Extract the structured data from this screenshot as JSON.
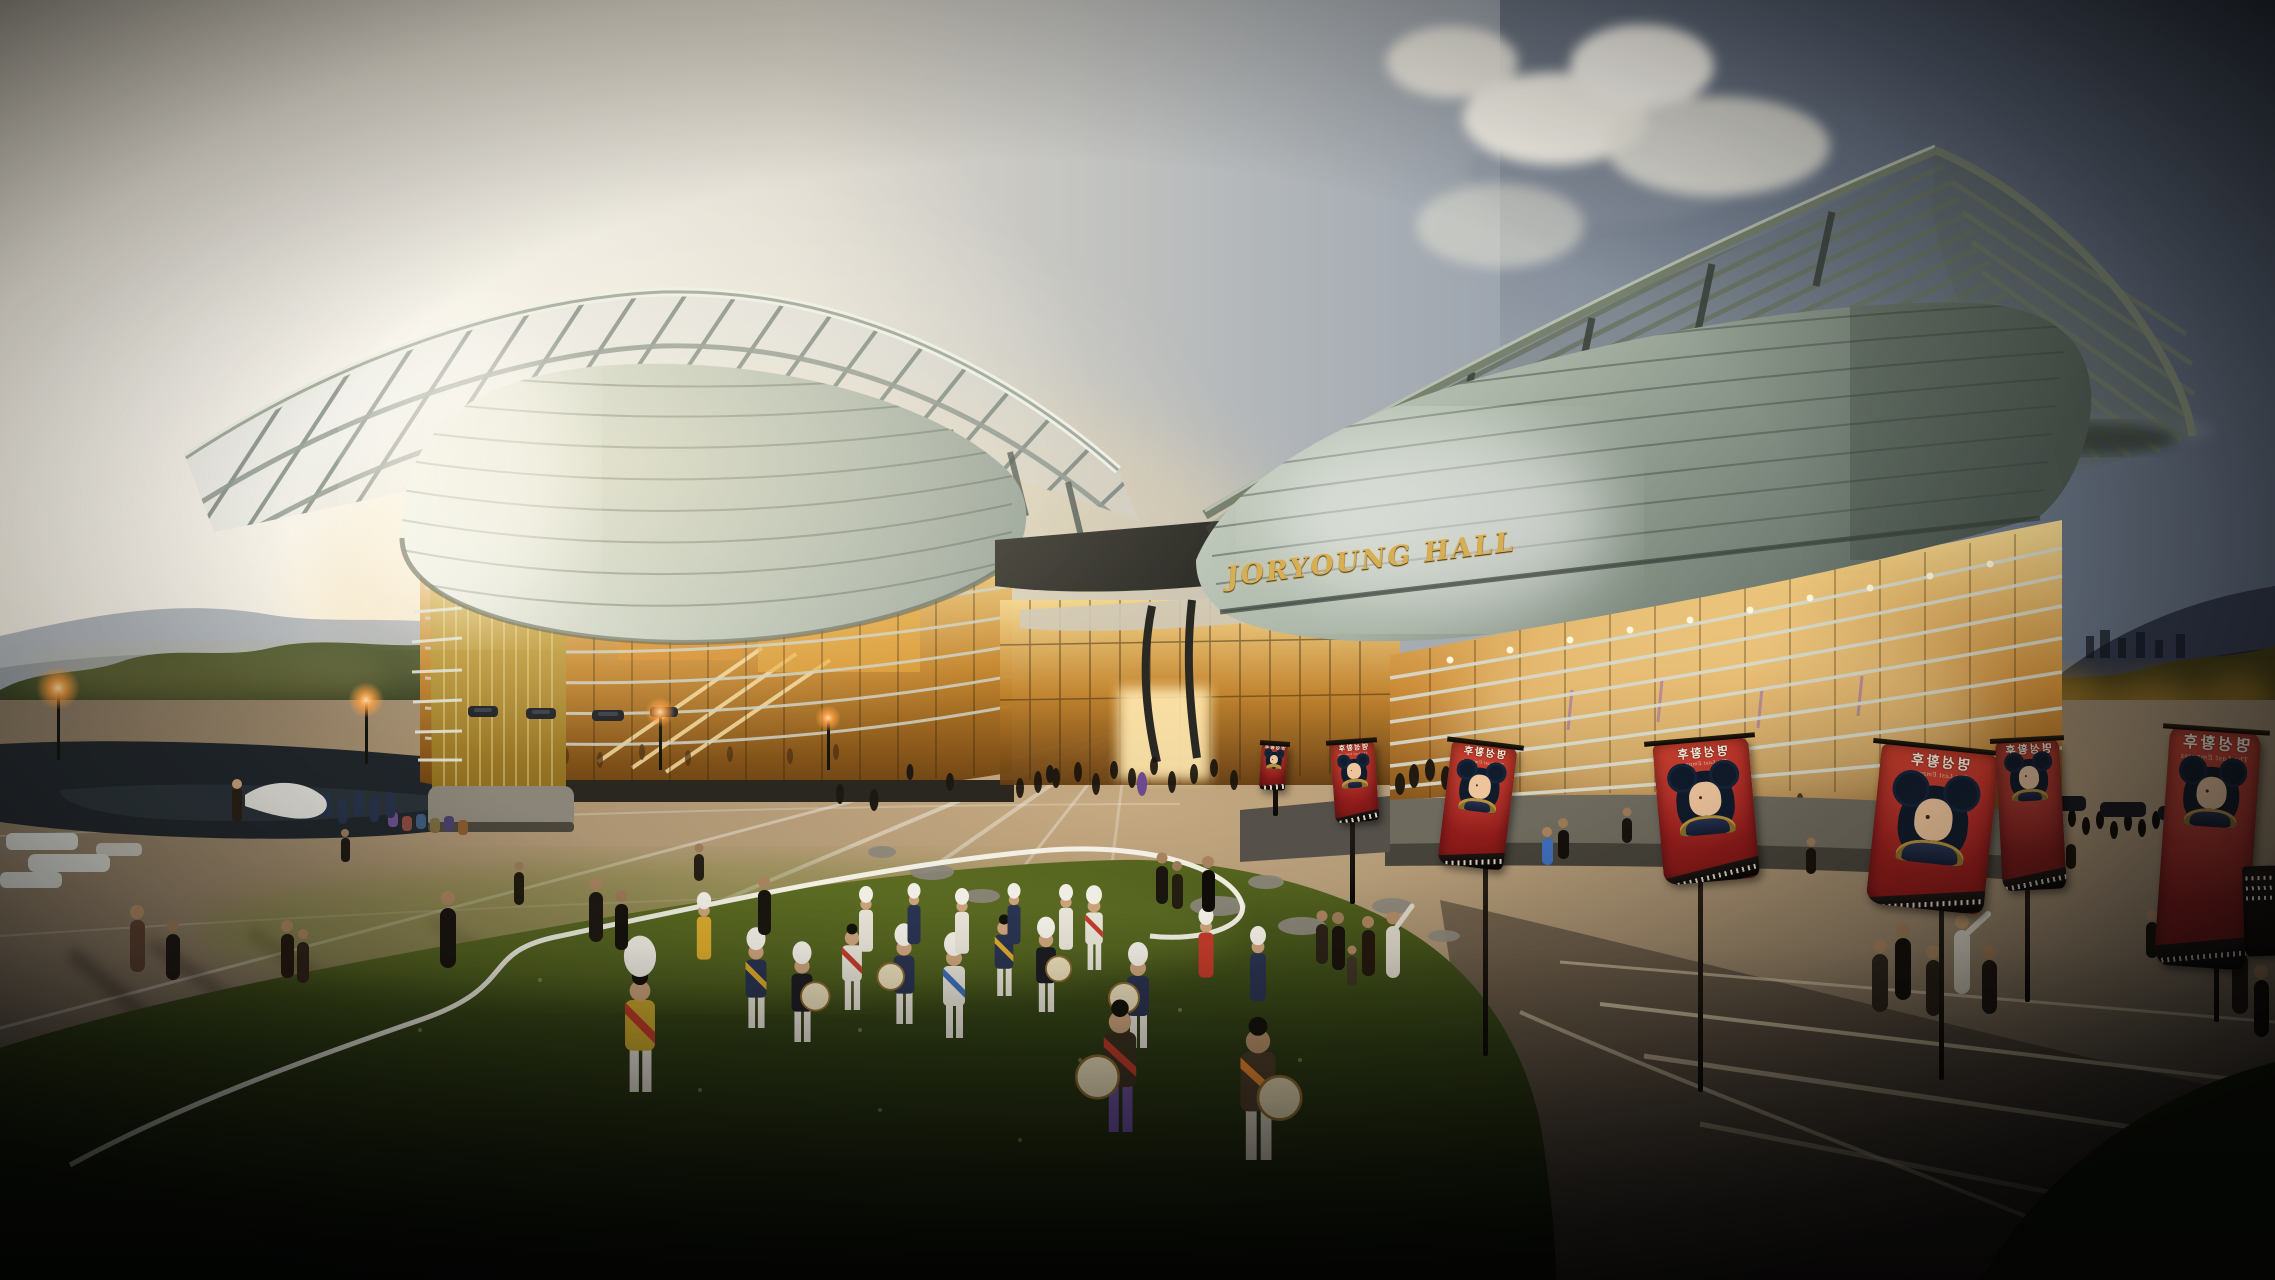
{
  "scene": {
    "description": "Dusk architectural rendering of a performing-arts complex with two winged halls, a plaza, a lawn with traditional Korean performers and rows of red event banners",
    "sign_text": "JORYOUNG HALL",
    "banner": {
      "title_ko": "명성황후",
      "caption": "The Last Empress",
      "mirrored": true
    },
    "palette": {
      "sky_warm": "#f2ead9",
      "sky_cool": "#59636f",
      "cloud_white": "#f6f3ea",
      "concrete_light": "#cdd5c8",
      "concrete_shadow": "#55605a",
      "glass_glow": "#f6d98e",
      "glass_deep": "#7a4a16",
      "plaza_warm": "#bfa57d",
      "plaza_shadow": "#403c35",
      "grass_light": "#6d7c2a",
      "grass_dark": "#0f140a",
      "banner_red": "#a42220",
      "gold_lettering": "#d8ae52",
      "lamp_orange": "#ff9d3d",
      "pond_dark": "#20262b"
    }
  }
}
